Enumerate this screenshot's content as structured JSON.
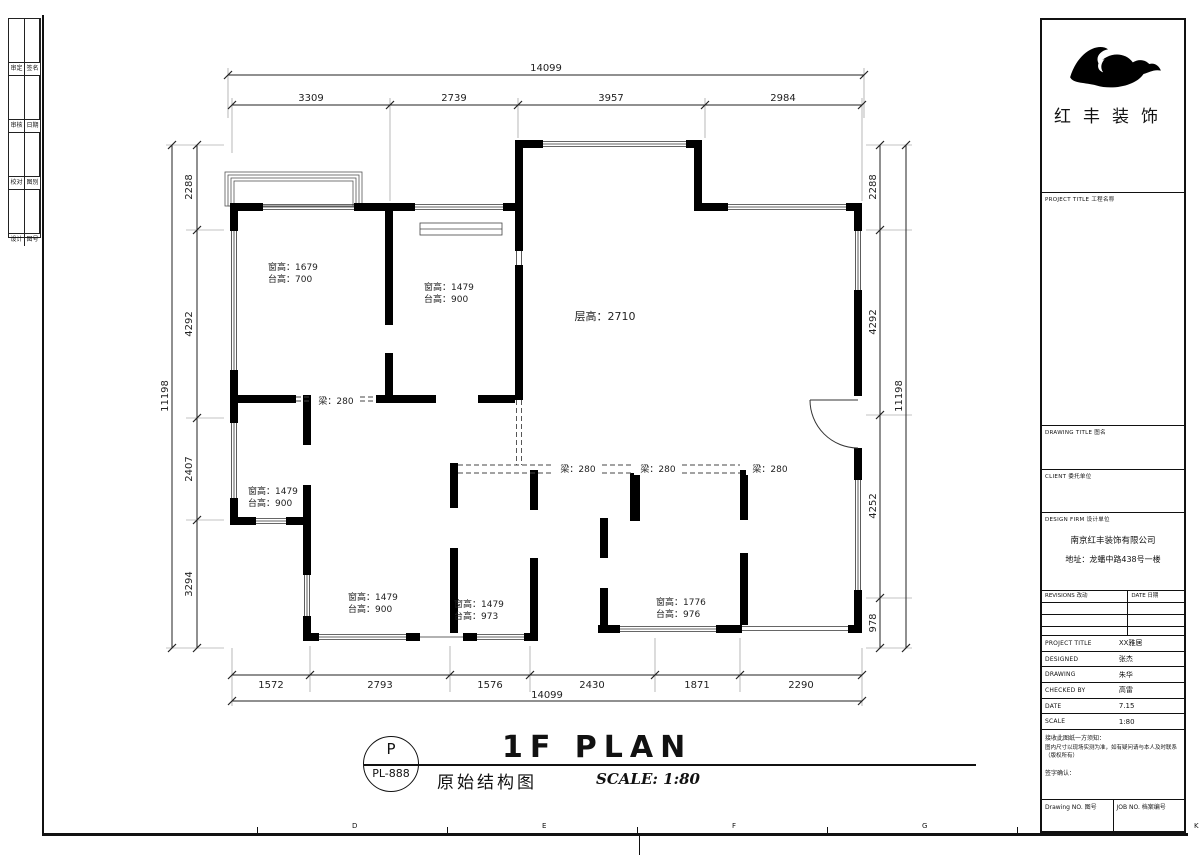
{
  "plan": {
    "floor_height": "层高：2710",
    "beams": [
      "梁：280",
      "梁：280",
      "梁：280",
      "梁：280"
    ],
    "rooms": [
      {
        "l1": "窗高：1679",
        "l2": "台高：700"
      },
      {
        "l1": "窗高：1479",
        "l2": "台高：900"
      },
      {
        "l1": "窗高：1479",
        "l2": "台高：900"
      },
      {
        "l1": "窗高：1479",
        "l2": "台高：900"
      },
      {
        "l1": "窗高：1479",
        "l2": "台高：973"
      },
      {
        "l1": "窗高：1776",
        "l2": "台高：976"
      }
    ],
    "dims": {
      "top_overall": "14099",
      "top": [
        "3309",
        "2739",
        "3957",
        "2984"
      ],
      "bottom": [
        "1572",
        "2793",
        "1576",
        "2430",
        "1871",
        "2290"
      ],
      "bottom_overall": "14099",
      "left": [
        "2288",
        "4292",
        "2407",
        "3294"
      ],
      "left_overall": "11198",
      "right": [
        "2288",
        "4292",
        "4252",
        "978"
      ],
      "right_overall": "11198"
    }
  },
  "footer": {
    "stamp_top": "P",
    "stamp_no": "PL-888",
    "drawing_name": "原始结构图",
    "title": "1F PLAN",
    "scale": "SCALE: 1:80"
  },
  "title_block": {
    "logo_text": "红丰装饰",
    "project_title_label": "PROJECT TITLE  工程名称",
    "drawing_title_label": "DRAWING TITLE  图名",
    "client_label": "CLIENT  委托单位",
    "design_firm_label": "DESIGN FIRM  设计单位",
    "company_name": "南京红丰装饰有限公司",
    "company_address": "地址：龙蟠中路438号一楼",
    "revisions_label": "REVISIONS 改动",
    "date_col_label": "DATE 日期",
    "info_rows": [
      {
        "label": "PROJECT TITLE",
        "value": "XX雅居"
      },
      {
        "label": "DESIGNED",
        "value": "张杰"
      },
      {
        "label": "DRAWING",
        "value": "朱华"
      },
      {
        "label": "CHECKED BY",
        "value": "高雷"
      },
      {
        "label": "DATE",
        "value": "7.15"
      },
      {
        "label": "SCALE",
        "value": "1:80"
      }
    ],
    "note_lines": [
      "接收此图纸一方须知：",
      "图内尺寸以现场实测为准，如有疑问请与本人及时联系（版权所有）",
      "签字确认："
    ],
    "drawing_no_label": "Drawing NO.  图号",
    "job_no_label": "JOB NO.  档案编号"
  },
  "sheet": {
    "edge_letters": [
      "D",
      "E",
      "F",
      "G",
      "H",
      "K"
    ],
    "strip_rows": [
      {
        "c1": "审定",
        "c2": "签名"
      },
      {
        "c1": "审核",
        "c2": "日期"
      },
      {
        "c1": "校对",
        "c2": "图别"
      },
      {
        "c1": "设计",
        "c2": "图号"
      }
    ]
  },
  "colors": {
    "line": "#1a1a1a",
    "wall": "#000000",
    "dim": "#333333"
  }
}
